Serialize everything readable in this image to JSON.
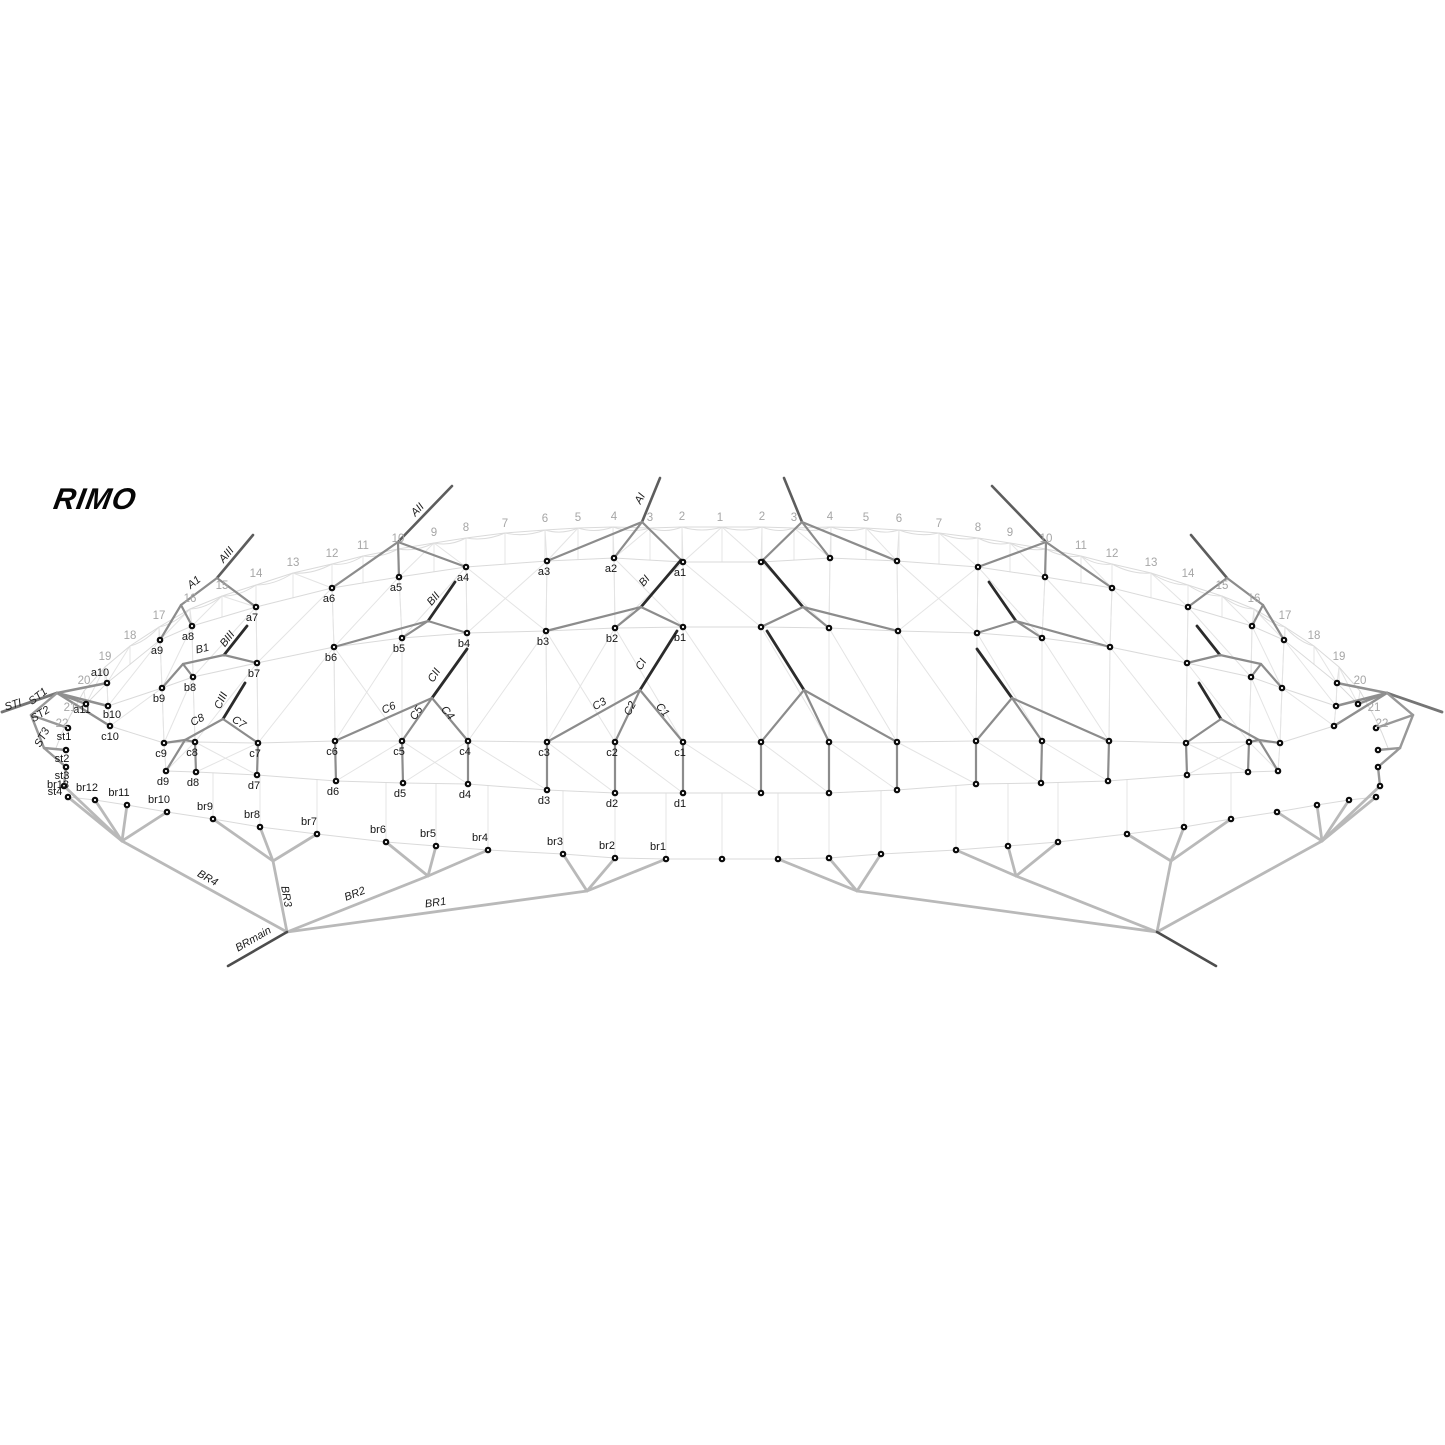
{
  "logo": {
    "text": "RIMO"
  },
  "colors": {
    "background": "#ffffff",
    "mesh": "#e4e4e4",
    "bridle_line": "#8c8c8c",
    "dark_stub": "#2b2b2b",
    "brake_line": "#b9b9b9",
    "number_gray": "#a6a6a6",
    "label_black": "#161616"
  },
  "cell_numbers": [
    {
      "t": "1",
      "x": 720,
      "y": 521,
      "mirror": false
    },
    {
      "t": "2",
      "x": 682,
      "y": 520,
      "mirror": true
    },
    {
      "t": "3",
      "x": 650,
      "y": 521,
      "mirror": true
    },
    {
      "t": "4",
      "x": 614,
      "y": 520,
      "mirror": true
    },
    {
      "t": "5",
      "x": 578,
      "y": 521,
      "mirror": true
    },
    {
      "t": "6",
      "x": 545,
      "y": 522,
      "mirror": true
    },
    {
      "t": "7",
      "x": 505,
      "y": 527,
      "mirror": true
    },
    {
      "t": "8",
      "x": 466,
      "y": 531,
      "mirror": true
    },
    {
      "t": "9",
      "x": 434,
      "y": 536,
      "mirror": true
    },
    {
      "t": "10",
      "x": 398,
      "y": 542,
      "mirror": true
    },
    {
      "t": "11",
      "x": 363,
      "y": 549,
      "mirror": true
    },
    {
      "t": "12",
      "x": 332,
      "y": 557,
      "mirror": true
    },
    {
      "t": "13",
      "x": 293,
      "y": 566,
      "mirror": true
    },
    {
      "t": "14",
      "x": 256,
      "y": 577,
      "mirror": true
    },
    {
      "t": "15",
      "x": 222,
      "y": 589,
      "mirror": true
    },
    {
      "t": "16",
      "x": 190,
      "y": 602,
      "mirror": true
    },
    {
      "t": "17",
      "x": 159,
      "y": 619,
      "mirror": true
    },
    {
      "t": "18",
      "x": 130,
      "y": 639,
      "mirror": true
    },
    {
      "t": "19",
      "x": 105,
      "y": 660,
      "mirror": true
    },
    {
      "t": "20",
      "x": 84,
      "y": 684,
      "mirror": true
    },
    {
      "t": "21",
      "x": 70,
      "y": 711,
      "mirror": true
    },
    {
      "t": "22",
      "x": 62,
      "y": 727,
      "mirror": true
    }
  ],
  "nodes": {
    "a1": {
      "x": 683,
      "y": 562,
      "label": "a1",
      "lx": 680,
      "ly": 576
    },
    "a2": {
      "x": 614,
      "y": 558,
      "label": "a2",
      "lx": 611,
      "ly": 572
    },
    "a3": {
      "x": 547,
      "y": 561,
      "label": "a3",
      "lx": 544,
      "ly": 575
    },
    "a4": {
      "x": 466,
      "y": 567,
      "label": "a4",
      "lx": 463,
      "ly": 581
    },
    "a5": {
      "x": 399,
      "y": 577,
      "label": "a5",
      "lx": 396,
      "ly": 591
    },
    "a6": {
      "x": 332,
      "y": 588,
      "label": "a6",
      "lx": 329,
      "ly": 602
    },
    "a7": {
      "x": 256,
      "y": 607,
      "label": "a7",
      "lx": 252,
      "ly": 621
    },
    "a8": {
      "x": 192,
      "y": 626,
      "label": "a8",
      "lx": 188,
      "ly": 640
    },
    "a9": {
      "x": 160,
      "y": 640,
      "label": "a9",
      "lx": 157,
      "ly": 654
    },
    "a10": {
      "x": 107,
      "y": 683,
      "label": "a10",
      "lx": 100,
      "ly": 676
    },
    "a11": {
      "x": 86,
      "y": 704,
      "label": "a11",
      "lx": 82,
      "ly": 713
    },
    "b1": {
      "x": 683,
      "y": 627,
      "label": "b1",
      "lx": 680,
      "ly": 641
    },
    "b2": {
      "x": 615,
      "y": 628,
      "label": "b2",
      "lx": 612,
      "ly": 642
    },
    "b3": {
      "x": 546,
      "y": 631,
      "label": "b3",
      "lx": 543,
      "ly": 645
    },
    "b4": {
      "x": 467,
      "y": 633,
      "label": "b4",
      "lx": 464,
      "ly": 647
    },
    "b5": {
      "x": 402,
      "y": 638,
      "label": "b5",
      "lx": 399,
      "ly": 652
    },
    "b6": {
      "x": 334,
      "y": 647,
      "label": "b6",
      "lx": 331,
      "ly": 661
    },
    "b7": {
      "x": 257,
      "y": 663,
      "label": "b7",
      "lx": 254,
      "ly": 677
    },
    "b8": {
      "x": 193,
      "y": 677,
      "label": "b8",
      "lx": 190,
      "ly": 691
    },
    "b9": {
      "x": 162,
      "y": 688,
      "label": "b9",
      "lx": 159,
      "ly": 702
    },
    "b10": {
      "x": 108,
      "y": 706,
      "label": "b10",
      "lx": 112,
      "ly": 718
    },
    "c1": {
      "x": 683,
      "y": 742,
      "label": "c1",
      "lx": 680,
      "ly": 756
    },
    "c2": {
      "x": 615,
      "y": 742,
      "label": "c2",
      "lx": 612,
      "ly": 756
    },
    "c3": {
      "x": 547,
      "y": 742,
      "label": "c3",
      "lx": 544,
      "ly": 756
    },
    "c4": {
      "x": 468,
      "y": 741,
      "label": "c4",
      "lx": 465,
      "ly": 755
    },
    "c5": {
      "x": 402,
      "y": 741,
      "label": "c5",
      "lx": 399,
      "ly": 755
    },
    "c6": {
      "x": 335,
      "y": 741,
      "label": "c6",
      "lx": 332,
      "ly": 755
    },
    "c7": {
      "x": 258,
      "y": 743,
      "label": "c7",
      "lx": 255,
      "ly": 757
    },
    "c8": {
      "x": 195,
      "y": 742,
      "label": "c8",
      "lx": 192,
      "ly": 756
    },
    "c9": {
      "x": 164,
      "y": 743,
      "label": "c9",
      "lx": 161,
      "ly": 757
    },
    "c10": {
      "x": 110,
      "y": 726,
      "label": "c10",
      "lx": 110,
      "ly": 740
    },
    "d1": {
      "x": 683,
      "y": 793,
      "label": "d1",
      "lx": 680,
      "ly": 807
    },
    "d2": {
      "x": 615,
      "y": 793,
      "label": "d2",
      "lx": 612,
      "ly": 807
    },
    "d3": {
      "x": 547,
      "y": 790,
      "label": "d3",
      "lx": 544,
      "ly": 804
    },
    "d4": {
      "x": 468,
      "y": 784,
      "label": "d4",
      "lx": 465,
      "ly": 798
    },
    "d5": {
      "x": 403,
      "y": 783,
      "label": "d5",
      "lx": 400,
      "ly": 797
    },
    "d6": {
      "x": 336,
      "y": 781,
      "label": "d6",
      "lx": 333,
      "ly": 795
    },
    "d7": {
      "x": 257,
      "y": 775,
      "label": "d7",
      "lx": 254,
      "ly": 789
    },
    "d8": {
      "x": 196,
      "y": 772,
      "label": "d8",
      "lx": 193,
      "ly": 786
    },
    "d9": {
      "x": 166,
      "y": 771,
      "label": "d9",
      "lx": 163,
      "ly": 785
    },
    "st1": {
      "x": 68,
      "y": 728,
      "label": "st1",
      "lx": 64,
      "ly": 740
    },
    "st2": {
      "x": 66,
      "y": 750,
      "label": "st2",
      "lx": 62,
      "ly": 762
    },
    "st3": {
      "x": 66,
      "y": 767,
      "label": "st3",
      "lx": 62,
      "ly": 779
    },
    "st4": {
      "x": 64,
      "y": 786,
      "label": "st4",
      "lx": 55,
      "ly": 795
    },
    "br13": {
      "x": 68,
      "y": 797,
      "label": "br13",
      "lx": 58,
      "ly": 788
    },
    "br1": {
      "x": 666,
      "y": 859,
      "label": "br1",
      "lx": 658,
      "ly": 850
    },
    "br2": {
      "x": 615,
      "y": 858,
      "label": "br2",
      "lx": 607,
      "ly": 849
    },
    "br3": {
      "x": 563,
      "y": 854,
      "label": "br3",
      "lx": 555,
      "ly": 845
    },
    "br4": {
      "x": 488,
      "y": 850,
      "label": "br4",
      "lx": 480,
      "ly": 841
    },
    "br5": {
      "x": 436,
      "y": 846,
      "label": "br5",
      "lx": 428,
      "ly": 837
    },
    "br6": {
      "x": 386,
      "y": 842,
      "label": "br6",
      "lx": 378,
      "ly": 833
    },
    "br7": {
      "x": 317,
      "y": 834,
      "label": "br7",
      "lx": 309,
      "ly": 825
    },
    "br8": {
      "x": 260,
      "y": 827,
      "label": "br8",
      "lx": 252,
      "ly": 818
    },
    "br9": {
      "x": 213,
      "y": 819,
      "label": "br9",
      "lx": 205,
      "ly": 810
    },
    "br10": {
      "x": 167,
      "y": 812,
      "label": "br10",
      "lx": 159,
      "ly": 803
    },
    "br11": {
      "x": 127,
      "y": 805,
      "label": "br11",
      "lx": 119,
      "ly": 796
    },
    "br12": {
      "x": 95,
      "y": 800,
      "label": "br12",
      "lx": 87,
      "ly": 791
    },
    "bc": {
      "x": 722,
      "y": 859
    }
  },
  "joints": {
    "jAI": {
      "x": 642,
      "y": 522
    },
    "sAI": {
      "x": 660,
      "y": 478
    },
    "jAII": {
      "x": 398,
      "y": 542
    },
    "sAII": {
      "x": 452,
      "y": 486
    },
    "fA": {
      "x": 217,
      "y": 578
    },
    "sAIII": {
      "x": 253,
      "y": 535
    },
    "jA1": {
      "x": 181,
      "y": 605
    },
    "jBI": {
      "x": 641,
      "y": 607
    },
    "sBI": {
      "x": 681,
      "y": 560
    },
    "jBII": {
      "x": 428,
      "y": 621
    },
    "sBII": {
      "x": 455,
      "y": 582
    },
    "fB": {
      "x": 224,
      "y": 655
    },
    "sBIII": {
      "x": 247,
      "y": 626
    },
    "jB1": {
      "x": 183,
      "y": 664
    },
    "jCI": {
      "x": 640,
      "y": 690
    },
    "sCI": {
      "x": 677,
      "y": 631
    },
    "jCII": {
      "x": 432,
      "y": 698
    },
    "sCII": {
      "x": 467,
      "y": 649
    },
    "fC": {
      "x": 223,
      "y": 719
    },
    "sCIII": {
      "x": 245,
      "y": 683
    },
    "jC8": {
      "x": 185,
      "y": 740
    },
    "jST": {
      "x": 57,
      "y": 693
    },
    "eSTI": {
      "x": 2,
      "y": 712
    },
    "jST2": {
      "x": 31,
      "y": 715
    },
    "jST3": {
      "x": 44,
      "y": 748
    },
    "jBRm": {
      "x": 287,
      "y": 932
    },
    "eBRm": {
      "x": 228,
      "y": 966
    },
    "jBR4": {
      "x": 122,
      "y": 841
    },
    "jBR3": {
      "x": 273,
      "y": 861
    },
    "jBR2": {
      "x": 428,
      "y": 876
    },
    "jBR1": {
      "x": 587,
      "y": 891
    }
  },
  "edges": [
    [
      "jAI",
      "sAI",
      "riser"
    ],
    [
      "jAII",
      "sAII",
      "riser"
    ],
    [
      "fA",
      "sAIII",
      "riser"
    ],
    [
      "jAI",
      "a1",
      "line"
    ],
    [
      "jAI",
      "a2",
      "line"
    ],
    [
      "jAI",
      "a3",
      "line"
    ],
    [
      "jAII",
      "a4",
      "line"
    ],
    [
      "jAII",
      "a5",
      "line"
    ],
    [
      "jAII",
      "a6",
      "line"
    ],
    [
      "fA",
      "a7",
      "line"
    ],
    [
      "fA",
      "jA1",
      "line"
    ],
    [
      "jA1",
      "a8",
      "line"
    ],
    [
      "jA1",
      "a9",
      "line"
    ],
    [
      "jBI",
      "sBI",
      "stub"
    ],
    [
      "jBI",
      "b1",
      "line"
    ],
    [
      "jBI",
      "b2",
      "line"
    ],
    [
      "jBI",
      "b3",
      "line"
    ],
    [
      "jBII",
      "sBII",
      "stub"
    ],
    [
      "jBII",
      "b4",
      "line"
    ],
    [
      "jBII",
      "b5",
      "line"
    ],
    [
      "jBII",
      "b6",
      "line"
    ],
    [
      "fB",
      "sBIII",
      "stub"
    ],
    [
      "fB",
      "b7",
      "line"
    ],
    [
      "fB",
      "jB1",
      "line"
    ],
    [
      "jB1",
      "b8",
      "line"
    ],
    [
      "jB1",
      "b9",
      "line"
    ],
    [
      "jCI",
      "sCI",
      "stub"
    ],
    [
      "jCI",
      "c1",
      "line"
    ],
    [
      "jCI",
      "c2",
      "line"
    ],
    [
      "jCI",
      "c3",
      "line"
    ],
    [
      "c1",
      "d1",
      "line"
    ],
    [
      "c2",
      "d2",
      "line"
    ],
    [
      "c3",
      "d3",
      "line"
    ],
    [
      "jCII",
      "sCII",
      "stub"
    ],
    [
      "jCII",
      "c4",
      "line"
    ],
    [
      "jCII",
      "c5",
      "line"
    ],
    [
      "jCII",
      "c6",
      "line"
    ],
    [
      "c4",
      "d4",
      "line"
    ],
    [
      "c5",
      "d5",
      "line"
    ],
    [
      "c6",
      "d6",
      "line"
    ],
    [
      "fC",
      "sCIII",
      "stub"
    ],
    [
      "fC",
      "c7",
      "line"
    ],
    [
      "c7",
      "d7",
      "line"
    ],
    [
      "fC",
      "jC8",
      "line"
    ],
    [
      "jC8",
      "c8",
      "line"
    ],
    [
      "jC8",
      "c9",
      "line"
    ],
    [
      "jC8",
      "d9",
      "line"
    ],
    [
      "c8",
      "d8",
      "line"
    ],
    [
      "jST",
      "a10",
      "fan"
    ],
    [
      "jST",
      "a11",
      "fan"
    ],
    [
      "jST",
      "b10",
      "fan"
    ],
    [
      "jST",
      "c10",
      "fan"
    ],
    [
      "jST",
      "eSTI",
      "sti"
    ],
    [
      "jST",
      "jST2",
      "st"
    ],
    [
      "jST2",
      "st1",
      "st"
    ],
    [
      "jST2",
      "jST3",
      "st"
    ],
    [
      "jST3",
      "st2",
      "st"
    ],
    [
      "jST3",
      "st3",
      "st"
    ],
    [
      "st3",
      "st4",
      "st"
    ],
    [
      "jBRm",
      "jBR4",
      "br"
    ],
    [
      "jBR4",
      "st4",
      "br"
    ],
    [
      "jBR4",
      "br13",
      "br"
    ],
    [
      "jBR4",
      "br12",
      "br"
    ],
    [
      "jBR4",
      "br11",
      "br"
    ],
    [
      "jBR4",
      "br10",
      "br"
    ],
    [
      "jBRm",
      "jBR3",
      "br"
    ],
    [
      "jBR3",
      "br9",
      "br"
    ],
    [
      "jBR3",
      "br8",
      "br"
    ],
    [
      "jBR3",
      "br7",
      "br"
    ],
    [
      "jBRm",
      "jBR2",
      "br"
    ],
    [
      "jBR2",
      "br6",
      "br"
    ],
    [
      "jBR2",
      "br5",
      "br"
    ],
    [
      "jBR2",
      "br4",
      "br"
    ],
    [
      "jBRm",
      "jBR1",
      "br"
    ],
    [
      "jBR1",
      "br3",
      "br"
    ],
    [
      "jBR1",
      "br2",
      "br"
    ],
    [
      "jBR1",
      "br1",
      "br"
    ],
    [
      "jBRm",
      "eBRm",
      "brmain"
    ]
  ],
  "line_labels": [
    {
      "t": "AI",
      "x": 643,
      "y": 500,
      "r": -62
    },
    {
      "t": "AII",
      "x": 420,
      "y": 512,
      "r": -47
    },
    {
      "t": "AIII",
      "x": 229,
      "y": 557,
      "r": -50
    },
    {
      "t": "A1",
      "x": 196,
      "y": 585,
      "r": -38
    },
    {
      "t": "BI",
      "x": 647,
      "y": 583,
      "r": -50
    },
    {
      "t": "BII",
      "x": 436,
      "y": 601,
      "r": -50
    },
    {
      "t": "BIII",
      "x": 230,
      "y": 641,
      "r": -52
    },
    {
      "t": "B1",
      "x": 203,
      "y": 652,
      "r": -13
    },
    {
      "t": "CI",
      "x": 644,
      "y": 666,
      "r": -60
    },
    {
      "t": "CII",
      "x": 437,
      "y": 677,
      "r": -58
    },
    {
      "t": "CIII",
      "x": 224,
      "y": 702,
      "r": -65
    },
    {
      "t": "C8",
      "x": 199,
      "y": 723,
      "r": -28
    },
    {
      "t": "C7",
      "x": 237,
      "y": 725,
      "r": 35
    },
    {
      "t": "C6",
      "x": 390,
      "y": 711,
      "r": -24
    },
    {
      "t": "C5",
      "x": 419,
      "y": 715,
      "r": -55
    },
    {
      "t": "C4",
      "x": 445,
      "y": 715,
      "r": 50
    },
    {
      "t": "C3",
      "x": 601,
      "y": 707,
      "r": -29
    },
    {
      "t": "C2",
      "x": 633,
      "y": 710,
      "r": -62
    },
    {
      "t": "C1",
      "x": 660,
      "y": 712,
      "r": 50
    },
    {
      "t": "STI",
      "x": 14,
      "y": 708,
      "r": -18
    },
    {
      "t": "ST1",
      "x": 40,
      "y": 699,
      "r": -38
    },
    {
      "t": "ST2",
      "x": 42,
      "y": 717,
      "r": -33
    },
    {
      "t": "ST3",
      "x": 45,
      "y": 739,
      "r": -62
    },
    {
      "t": "BR4",
      "x": 206,
      "y": 881,
      "r": 29
    },
    {
      "t": "BR3",
      "x": 283,
      "y": 897,
      "r": 80
    },
    {
      "t": "BR2",
      "x": 356,
      "y": 897,
      "r": -21
    },
    {
      "t": "BR1",
      "x": 436,
      "y": 906,
      "r": -8
    },
    {
      "t": "BRmain",
      "x": 255,
      "y": 942,
      "r": -30
    }
  ],
  "mesh": {
    "leading_edge": [
      [
        56,
        748
      ],
      [
        62,
        733
      ],
      [
        70,
        716
      ],
      [
        84,
        691
      ],
      [
        105,
        667
      ],
      [
        130,
        646
      ],
      [
        159,
        627
      ],
      [
        190,
        609
      ],
      [
        222,
        596
      ],
      [
        256,
        585
      ],
      [
        293,
        573
      ],
      [
        332,
        564
      ],
      [
        363,
        556
      ],
      [
        398,
        549
      ],
      [
        434,
        543
      ],
      [
        466,
        538
      ],
      [
        505,
        533
      ],
      [
        545,
        530
      ],
      [
        578,
        528
      ],
      [
        613,
        527
      ],
      [
        650,
        528
      ],
      [
        682,
        527
      ],
      [
        722,
        527
      ]
    ],
    "rows": {
      "a": [
        "a11",
        "a10",
        "a9",
        "a8",
        "a7",
        "a6",
        "a5",
        "a4",
        "a3",
        "a2",
        "a1"
      ],
      "b": [
        "b10",
        "b9",
        "b8",
        "b7",
        "b6",
        "b5",
        "b4",
        "b3",
        "b2",
        "b1"
      ],
      "c": [
        "c10",
        "c9",
        "c8",
        "c7",
        "c6",
        "c5",
        "c4",
        "c3",
        "c2",
        "c1"
      ],
      "d": [
        "d9",
        "d8",
        "d7",
        "d6",
        "d5",
        "d4",
        "d3",
        "d2",
        "d1"
      ],
      "br": [
        "br13",
        "br12",
        "br11",
        "br10",
        "br9",
        "br8",
        "br7",
        "br6",
        "br5",
        "br4",
        "br3",
        "br2",
        "br1",
        "bc"
      ]
    }
  }
}
